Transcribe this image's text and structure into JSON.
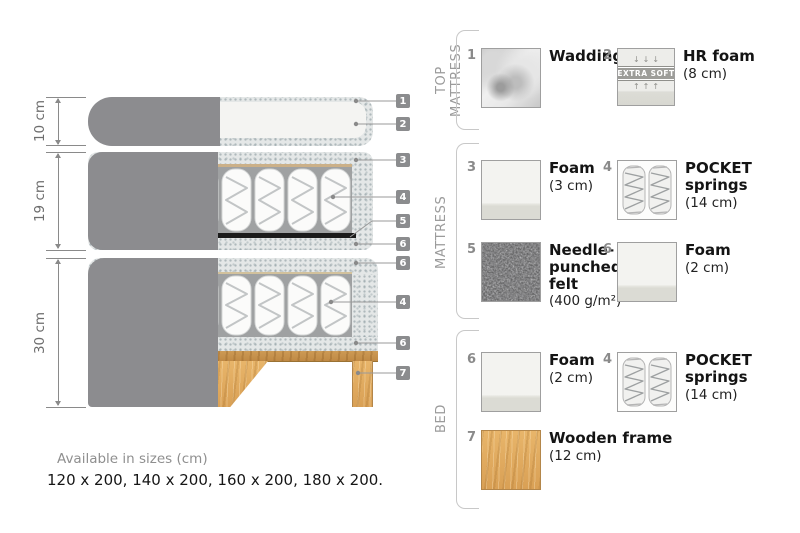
{
  "diagram": {
    "measurements": [
      "10 cm",
      "19 cm",
      "30 cm"
    ],
    "callouts": [
      "1",
      "2",
      "3",
      "4",
      "5",
      "6",
      "6",
      "4",
      "6",
      "7"
    ]
  },
  "legend": {
    "sections": [
      {
        "title": "TOP MATTRESS",
        "items": [
          {
            "num": "1",
            "name": "Wadding",
            "dim": ""
          },
          {
            "num": "2",
            "name": "HR foam",
            "dim": "(8 cm)"
          }
        ]
      },
      {
        "title": "MATTRESS",
        "items": [
          {
            "num": "3",
            "name": "Foam",
            "dim": "(3 cm)"
          },
          {
            "num": "4",
            "name": "POCKET springs",
            "dim": "(14 cm)"
          },
          {
            "num": "5",
            "name": "Needle-punched felt",
            "dim": "(400 g/m²)"
          },
          {
            "num": "6",
            "name": "Foam",
            "dim": "(2 cm)"
          }
        ]
      },
      {
        "title": "BED",
        "items": [
          {
            "num": "6",
            "name": "Foam",
            "dim": "(2 cm)"
          },
          {
            "num": "4",
            "name": "POCKET springs",
            "dim": "(14 cm)"
          },
          {
            "num": "7",
            "name": "Wooden frame",
            "dim": "(12 cm)"
          }
        ]
      }
    ]
  },
  "hr_foam_badge": {
    "label": "EXTRA SOFT",
    "arrows_down": "↓↓↓",
    "arrows_up": "↑↑↑"
  },
  "footer": {
    "title": "Available in sizes (cm)",
    "sizes": "120 x 200, 140 x 200, 160 x 200, 180 x 200."
  },
  "colors": {
    "fabric": "#8c8c8f",
    "wood": "#dfa95e",
    "badge": "#8b8c8e",
    "felt": "#5a5a5a"
  }
}
